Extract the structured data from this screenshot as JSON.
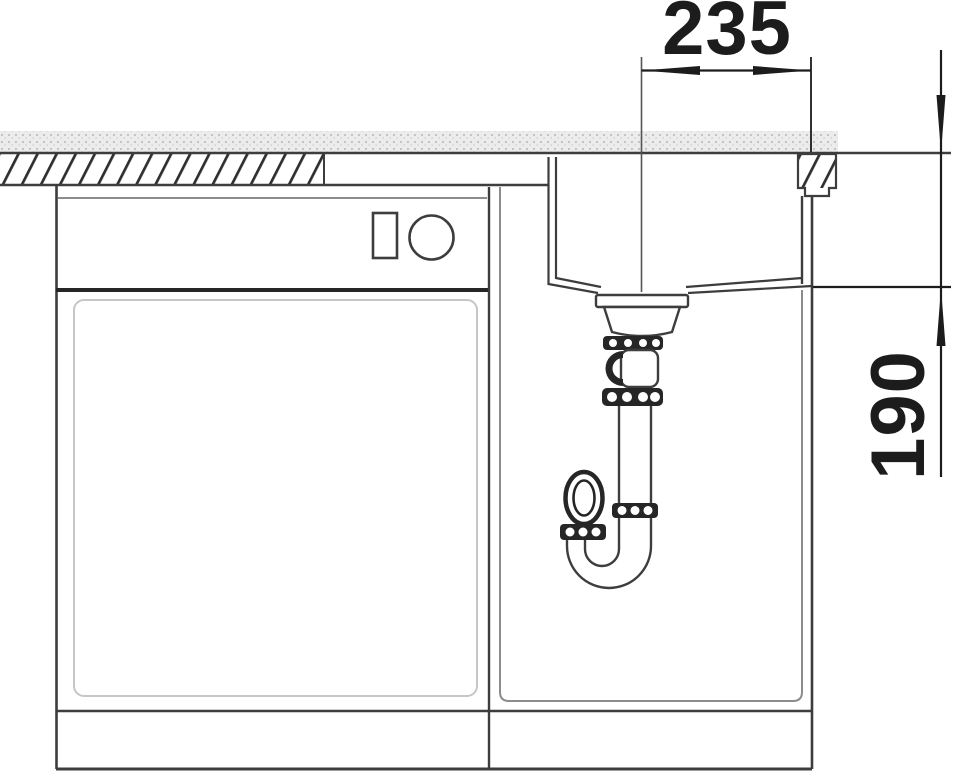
{
  "drawing": {
    "title": "Sink and cabinet installation cross-section",
    "dimension_horizontal": "235",
    "dimension_vertical": "190"
  },
  "colors": {
    "line": "#3d3d3d",
    "dimension": "#1c1c1c",
    "dark_fill": "#262626",
    "inner_outline": "#8c8c8c",
    "faint_outline": "#c6c6c6",
    "hatch": "#2f2f2f",
    "counter_base": "#ececec",
    "counter_dot": "#bfbfbf",
    "background": "#ffffff"
  }
}
